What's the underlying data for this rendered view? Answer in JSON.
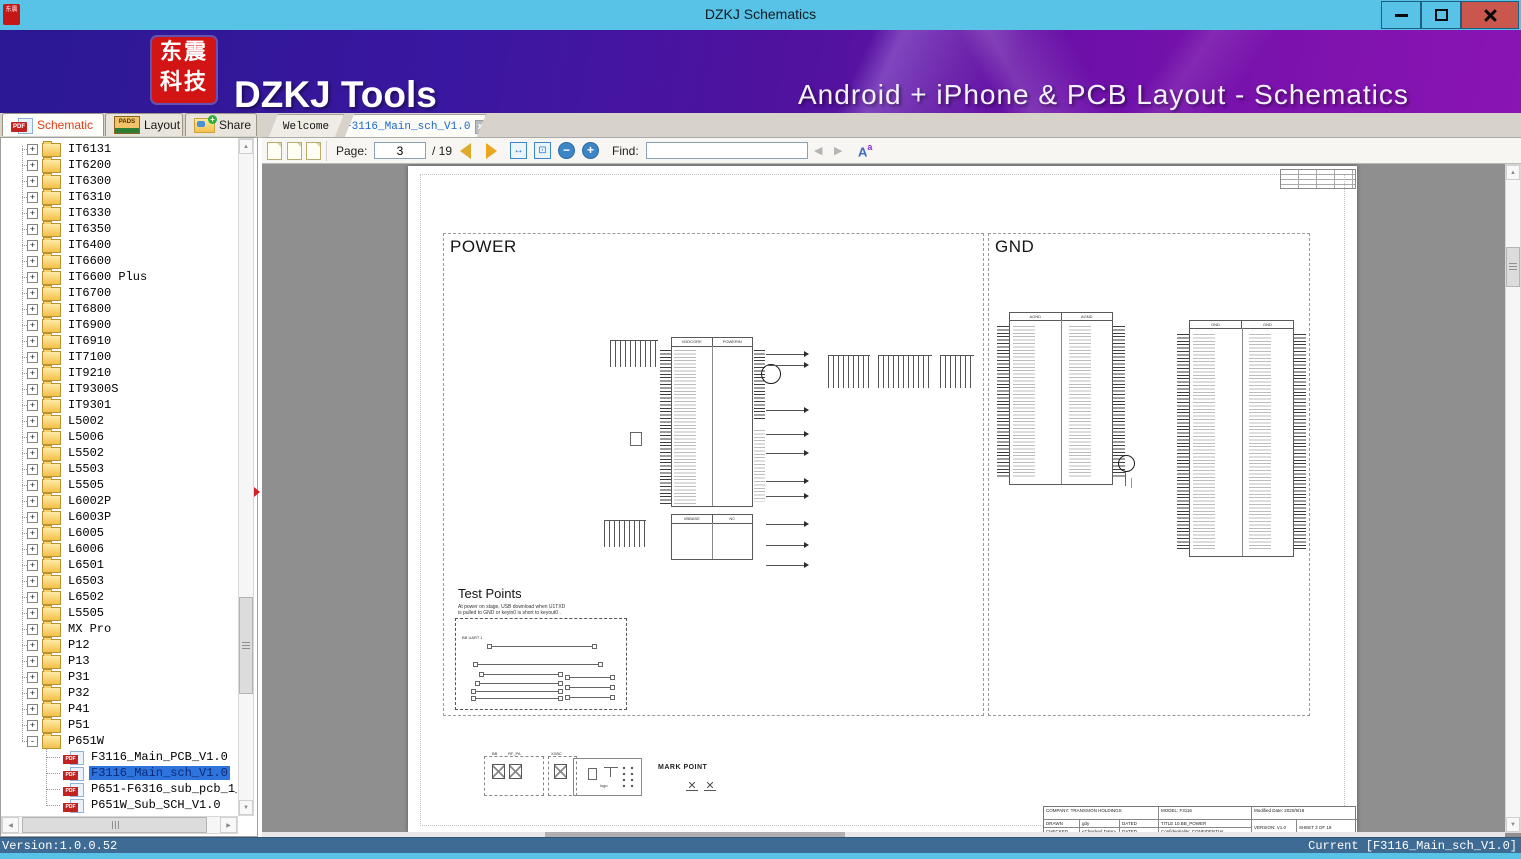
{
  "window": {
    "title": "DZKJ Schematics"
  },
  "banner": {
    "logo_line1": "东震",
    "logo_line2": "科技",
    "app_name": "DZKJ Tools",
    "tagline": "Android + iPhone & PCB Layout - Schematics"
  },
  "tabs": {
    "app": [
      {
        "label": "Schematic"
      },
      {
        "label": "Layout"
      },
      {
        "label": "Share"
      }
    ],
    "docs": [
      {
        "label": "Welcome"
      },
      {
        "label": "F3116_Main_sch_V1.0"
      }
    ]
  },
  "toolbar": {
    "page_label": "Page:",
    "page_value": "3",
    "page_total": "/ 19",
    "find_label": "Find:",
    "find_value": ""
  },
  "icons": {
    "pdf_badge": "PDF",
    "pads_text": "PADS",
    "share_plus": "+",
    "expand": "+",
    "collapse": "-",
    "close_tab": "x",
    "fit_width": "↔",
    "fit_page": "⊡",
    "zoom_out": "−",
    "zoom_in": "+",
    "find_prev": "◀",
    "find_next": "▶",
    "font_case_A": "A",
    "font_case_a": "a",
    "scroll_up": "▲",
    "scroll_down": "▼",
    "scroll_left": "◀",
    "scroll_right": "▶"
  },
  "tree": {
    "folders": [
      "IT6131",
      "IT6200",
      "IT6300",
      "IT6310",
      "IT6330",
      "IT6350",
      "IT6400",
      "IT6600",
      "IT6600 Plus",
      "IT6700",
      "IT6800",
      "IT6900",
      "IT6910",
      "IT7100",
      "IT9210",
      "IT9300S",
      "IT9301",
      "L5002",
      "L5006",
      "L5502",
      "L5503",
      "L5505",
      "L6002P",
      "L6003P",
      "L6005",
      "L6006",
      "L6501",
      "L6503",
      "L6502",
      "L5505",
      "MX Pro",
      "P12",
      "P13",
      "P31",
      "P32",
      "P41",
      "P51"
    ],
    "expanded_folder": "P651W",
    "files": [
      {
        "label": "F3116_Main_PCB_V1.0",
        "selected": false
      },
      {
        "label": "F3116_Main_sch_V1.0",
        "selected": true
      },
      {
        "label": "P651-F6316_sub_pcb_1_4L-V",
        "selected": false
      },
      {
        "label": "P651W_Sub_SCH_V1.0",
        "selected": false
      }
    ]
  },
  "page": {
    "power_title": "POWER",
    "gnd_title": "GND",
    "ic1_left_header": "VDDCORE",
    "ic1_right_header": "POWERIN",
    "ic2_left_header": "VBBASE",
    "ic2_right_header": "NC",
    "gnd_block1_left": "AGND",
    "gnd_block1_right": "AGND",
    "gnd_block2_left": "GND",
    "gnd_block2_right": "GND",
    "test_points": {
      "title": "Test Points",
      "note1": "At power on stage, USB download when U1TXD",
      "note2": "is pulled to GND or keyin0 is short to keyout0 .",
      "label": "BB UART 1"
    },
    "bottom": {
      "labels": [
        "BB",
        "RF_PA",
        "XXBC"
      ],
      "logo": "logo",
      "mark_point": "MARK POINT"
    },
    "title_block": {
      "company": "COMPANY: TRANSSION HOLDINGS",
      "model": "MODEL:    F3116",
      "modified": "Modified Date:    2020/9/18",
      "drawn": "DRAWN",
      "drawn_by": "gdy",
      "dated1": "DATED",
      "title": "TITLE    10.BB_POWER",
      "checked": "CHECKED",
      "checked_by": "<Checked Date>",
      "dated2": "DATED",
      "confidentiality": "Confidentiality:      CONFIDENTIAL",
      "version": "VERSION:   V1.0",
      "sheet": "SHEET 3   OF   19"
    }
  },
  "statusbar": {
    "version": "Version:1.0.0.52",
    "current": "Current [F3116_Main_sch_V1.0]"
  }
}
